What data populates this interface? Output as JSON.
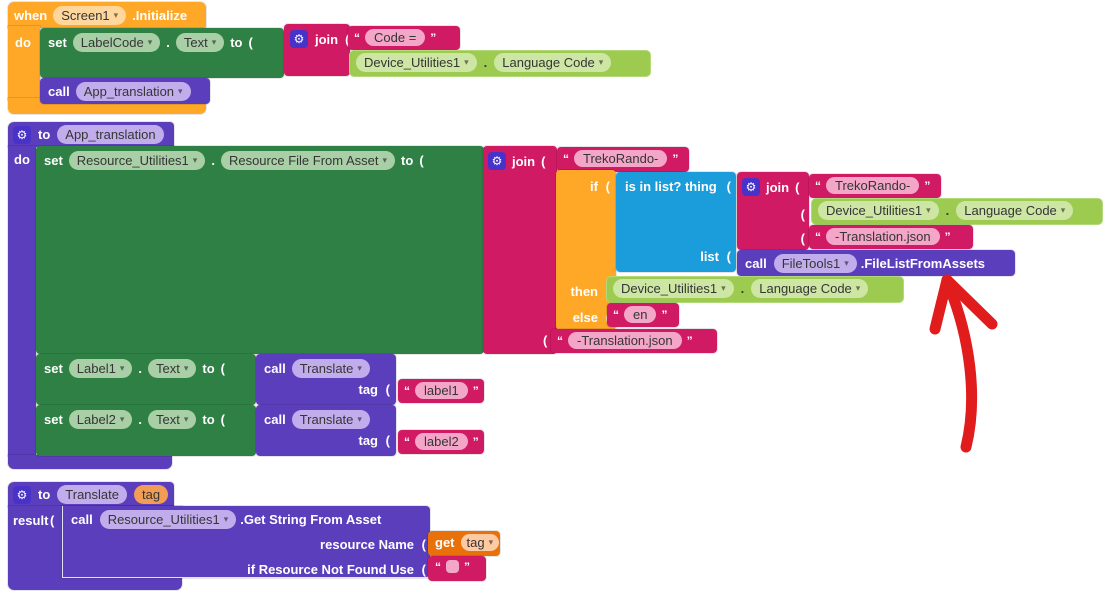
{
  "colors": {
    "event_orange": "#FFA726",
    "setter_green": "#2E8044",
    "text_crimson": "#D01A63",
    "list_blue": "#1A9DDA",
    "procedure_purple": "#5B3EBC",
    "component_getter_green": "#9CCB50",
    "variable_orange": "#E8710A",
    "annotation_red": "#E11C1C"
  },
  "labels": {
    "when": "when",
    "do": "do",
    "set": "set",
    "to": "to",
    "call": "call",
    "join": "join",
    "if": "if",
    "then": "then",
    "else": "else",
    "list": "list",
    "result": "result",
    "get": "get",
    "tag": "tag",
    "dot": ".",
    "po": "(",
    "qo": "“",
    "qc": "”",
    "gear": "⚙",
    "dd": "▾"
  },
  "shared": {
    "device": "Device_Utilities1",
    "lang": "Language Code"
  },
  "when_block": {
    "screen": "Screen1",
    "event": ".Initialize",
    "component": "LabelCode",
    "property": "Text",
    "str": "Code =",
    "call_proc": "App_translation"
  },
  "app_translation": {
    "name": "App_translation",
    "set_component": "Resource_Utilities1",
    "set_property": "Resource File From Asset",
    "str_treko": "TrekoRando-",
    "is_in_list": "is in list? thing",
    "file_component": "FileTools1",
    "file_method": ".FileListFromAssets",
    "str_json": "-Translation.json",
    "str_en": "en",
    "label1": "Label1",
    "label2": "Label2",
    "text_property": "Text",
    "translate": "Translate",
    "str_label1": "label1",
    "str_label2": "label2"
  },
  "translate_block": {
    "name": "Translate",
    "param": "tag",
    "component": "Resource_Utilities1",
    "method": ".Get String From Asset",
    "arg1": "resource Name",
    "arg2": "if Resource Not Found Use",
    "get_var": "tag"
  }
}
